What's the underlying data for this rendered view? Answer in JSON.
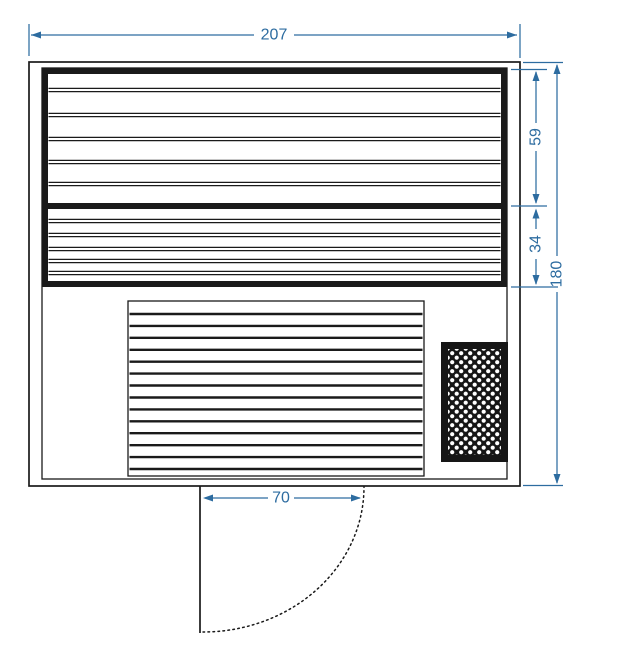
{
  "drawing": {
    "type": "sauna-floor-plan",
    "colors": {
      "dimension_blue": "#2d6ca0",
      "line_black": "#1a1a1a",
      "background": "#ffffff"
    },
    "dimensions": {
      "overall_width": {
        "value": "207"
      },
      "upper_bench_depth": {
        "value": "59"
      },
      "lower_bench_depth": {
        "value": "34"
      },
      "overall_depth": {
        "value": "180"
      },
      "door_opening_width": {
        "value": "70"
      }
    }
  }
}
